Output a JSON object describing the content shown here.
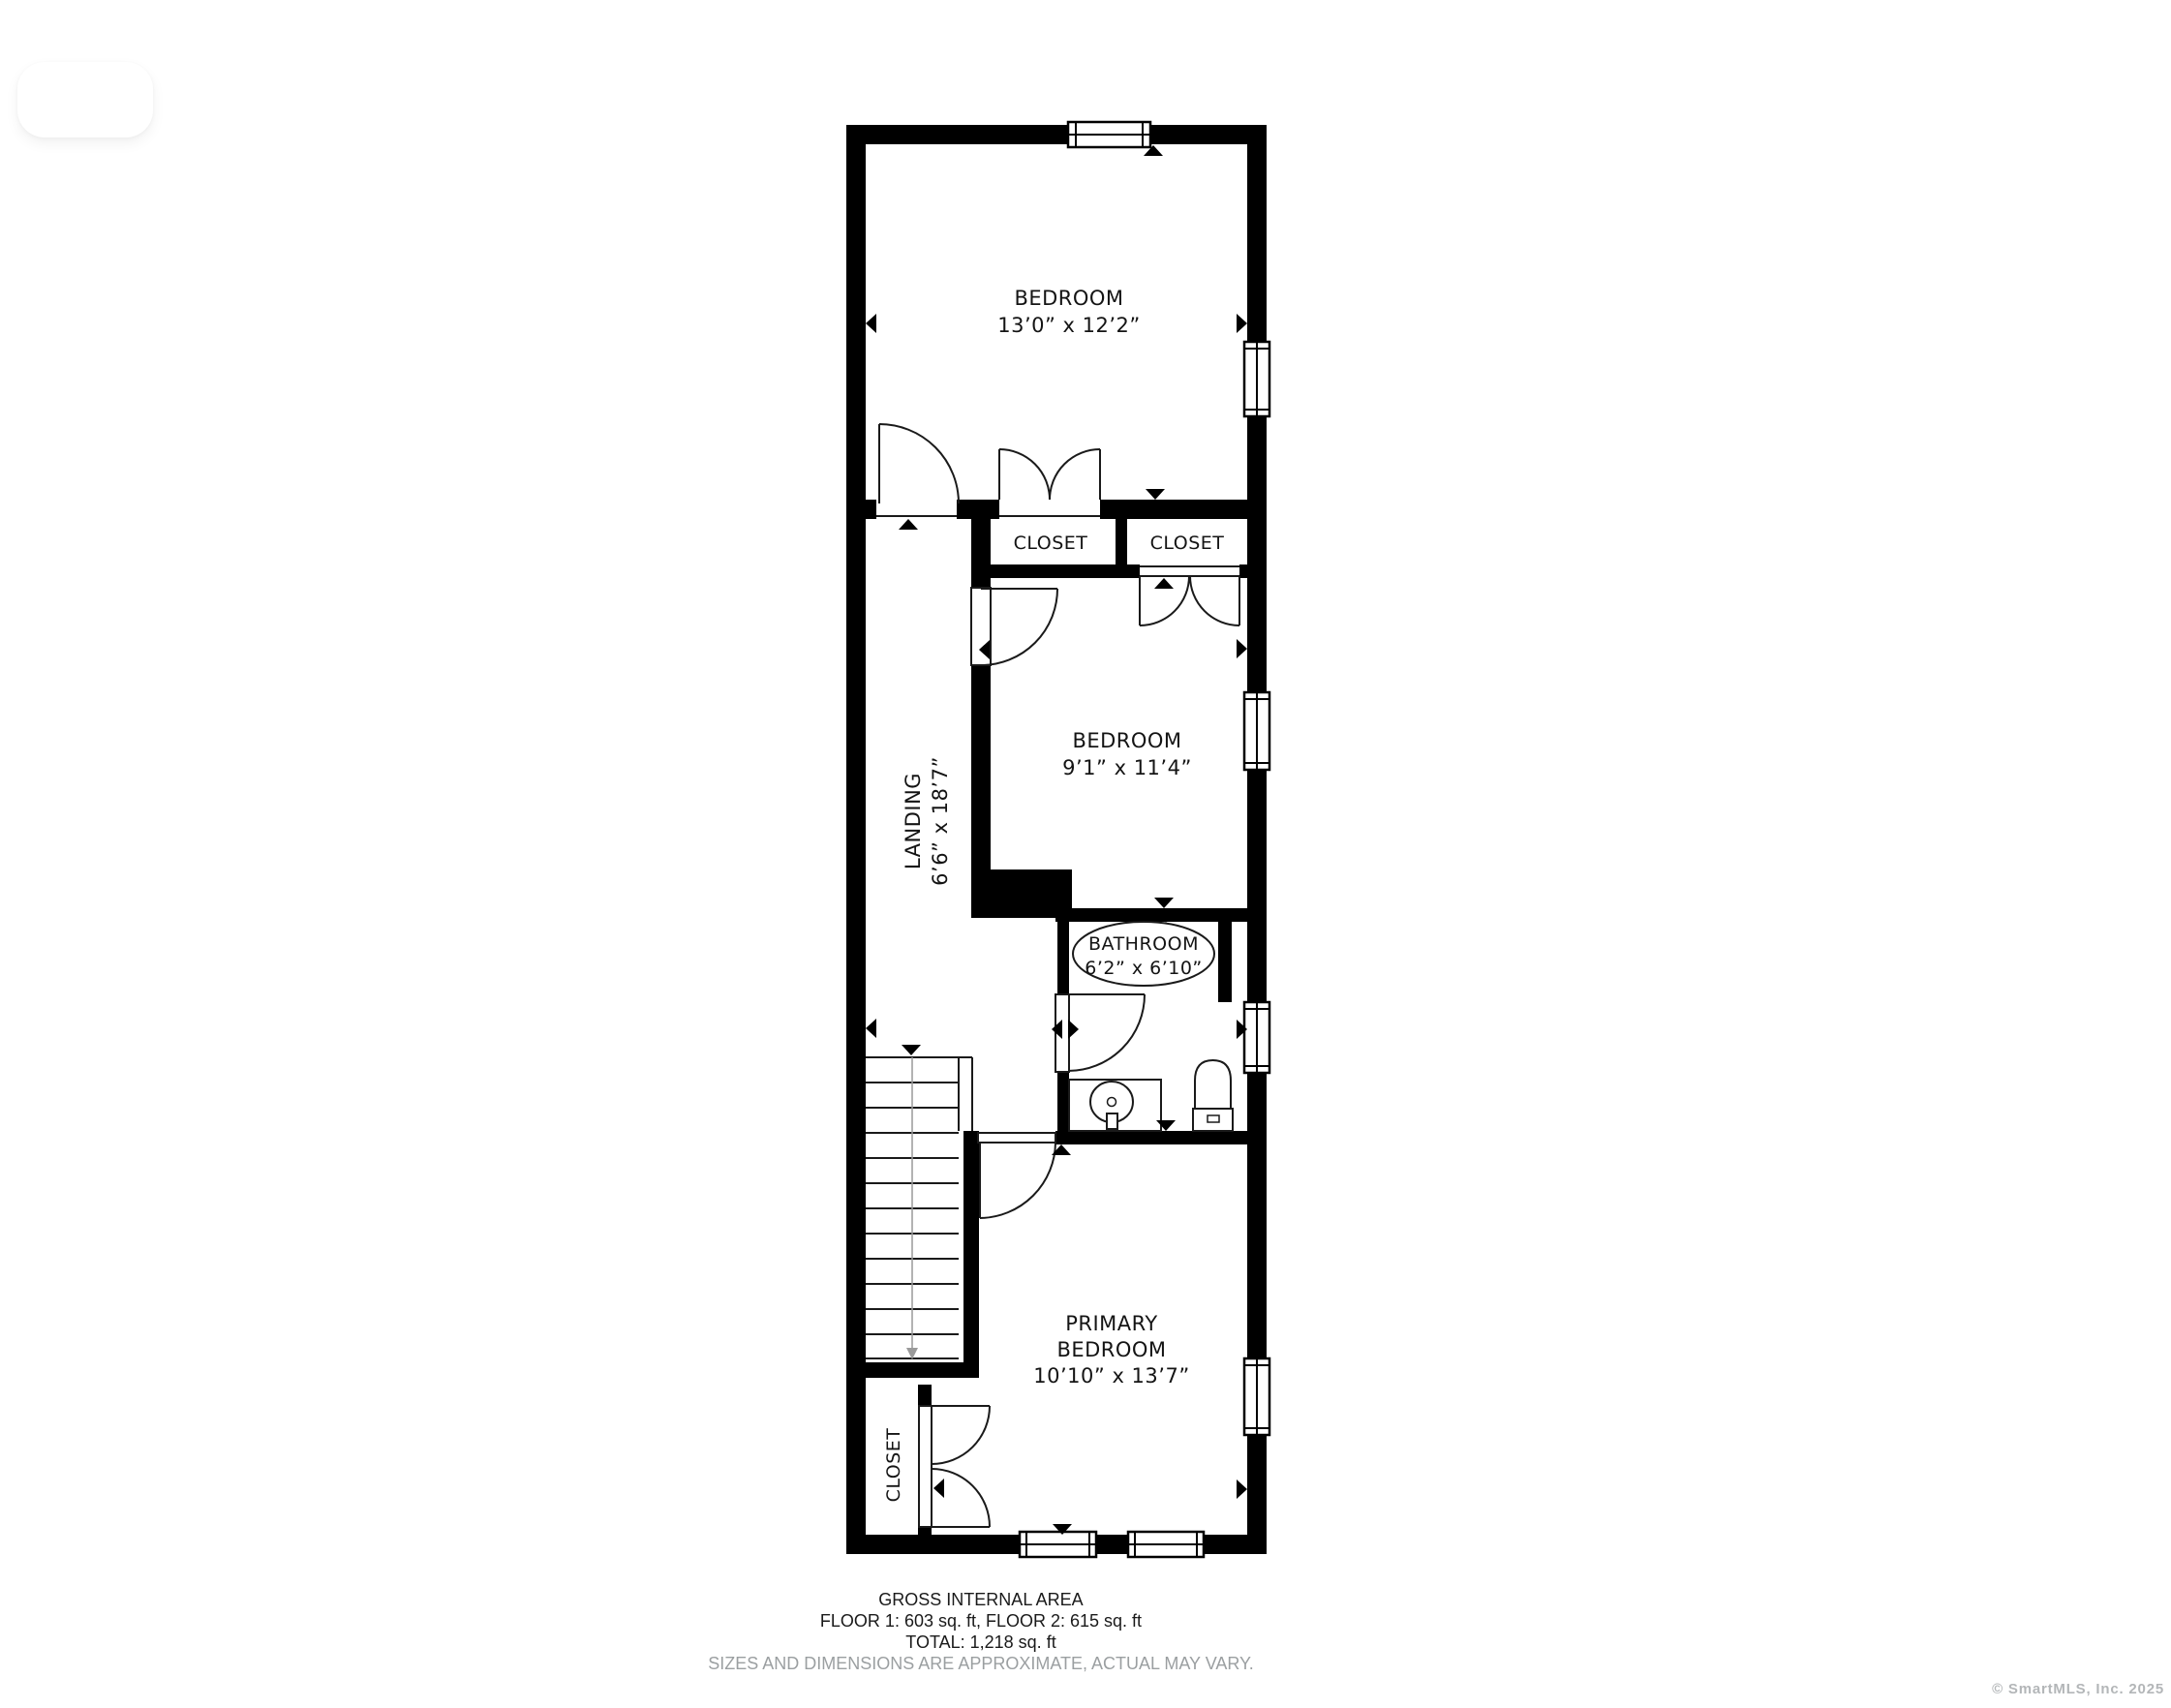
{
  "plan": {
    "rooms": {
      "bedroom_top": {
        "name": "BEDROOM",
        "dims": "13’0” x 12’2”"
      },
      "closet_left": {
        "name": "CLOSET"
      },
      "closet_right": {
        "name": "CLOSET"
      },
      "bedroom_middle": {
        "name": "BEDROOM",
        "dims": "9’1” x 11’4”"
      },
      "landing": {
        "name": "LANDING",
        "dims": "6’6” x 18’7”"
      },
      "bathroom": {
        "name": "BATHROOM",
        "dims": "6’2” x 6’10”"
      },
      "primary_bedroom": {
        "name_line1": "PRIMARY",
        "name_line2": "BEDROOM",
        "dims": "10’10” x 13’7”"
      },
      "closet_primary": {
        "name": "CLOSET"
      }
    }
  },
  "footer": {
    "title": "GROSS INTERNAL AREA",
    "floors": "FLOOR 1: 603 sq. ft, FLOOR 2: 615 sq. ft",
    "total": "TOTAL: 1,218 sq. ft",
    "disclaimer": "SIZES AND DIMENSIONS ARE APPROXIMATE, ACTUAL MAY VARY."
  },
  "watermark": "© SmartMLS, Inc. 2025",
  "colors": {
    "wall": "#000000",
    "text": "#141414",
    "muted_text": "#9b9fa1",
    "watermark": "#b3b6b8",
    "background": "#ffffff"
  }
}
